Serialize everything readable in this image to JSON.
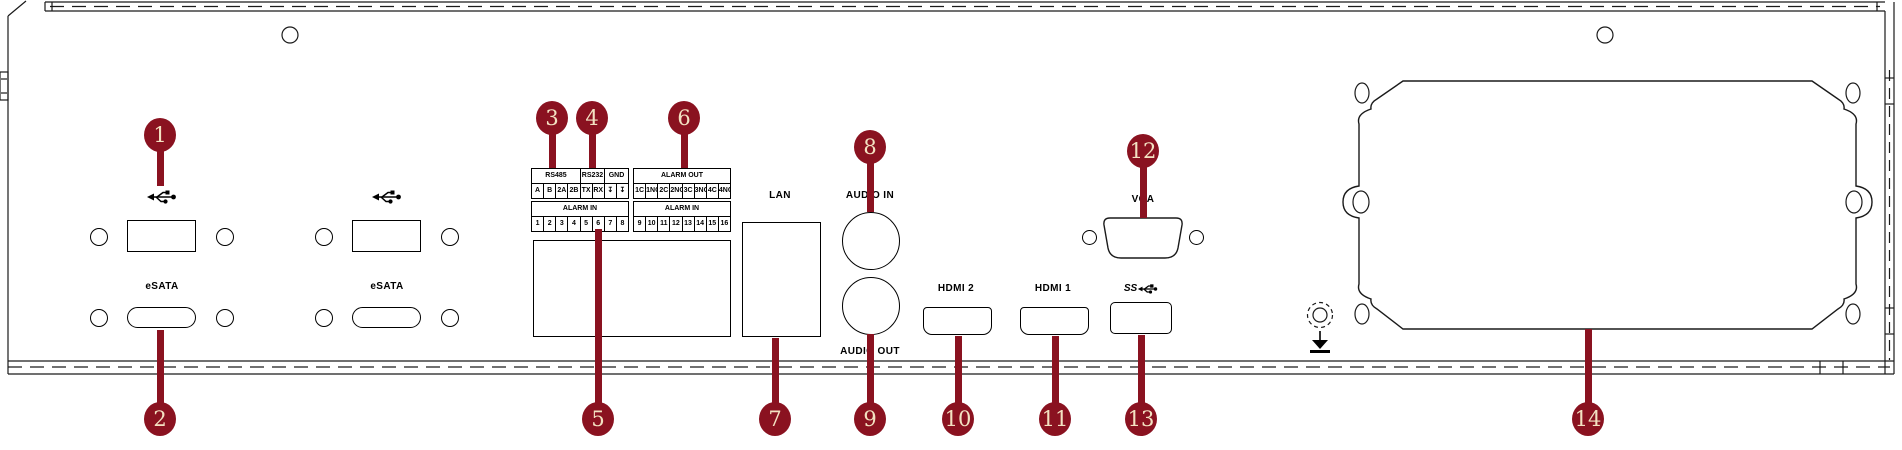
{
  "colors": {
    "callout_bg": "#8A1220",
    "callout_text": "#F3E2C2",
    "line": "#000000"
  },
  "panel": {
    "usb_groups": [
      {
        "icon": "usb-icon",
        "esata_label": "eSATA"
      },
      {
        "icon": "usb-icon",
        "esata_label": "eSATA"
      }
    ],
    "lan_label": "LAN",
    "audio_in_label": "AUDIO IN",
    "audio_out_label": "AUDIO OUT",
    "hdmi2_label": "HDMI 2",
    "hdmi1_label": "HDMI 1",
    "usb3_label": "SS",
    "vga_label": "VGA"
  },
  "terminal_block_a": {
    "headers": [
      {
        "label": "RS485",
        "span": 4
      },
      {
        "label": "RS232",
        "span": 2
      },
      {
        "label": "GND",
        "span": 2
      }
    ],
    "pins": [
      "A",
      "B",
      "2A",
      "2B",
      "TX",
      "RX",
      "↧",
      "↧"
    ],
    "alarm_in_label": "ALARM IN",
    "alarm_in_pins": [
      "1",
      "2",
      "3",
      "4",
      "5",
      "6",
      "7",
      "8"
    ]
  },
  "terminal_block_b": {
    "alarm_out_label": "ALARM OUT",
    "alarm_out_pins": [
      "1C",
      "1NO",
      "2C",
      "2NO",
      "3C",
      "3NO",
      "4C",
      "4NO"
    ],
    "alarm_in_label": "ALARM IN",
    "alarm_in_pins": [
      "9",
      "10",
      "11",
      "12",
      "13",
      "14",
      "15",
      "16"
    ]
  },
  "callouts": [
    {
      "number": "1"
    },
    {
      "number": "2"
    },
    {
      "number": "3"
    },
    {
      "number": "4"
    },
    {
      "number": "5"
    },
    {
      "number": "6"
    },
    {
      "number": "7"
    },
    {
      "number": "8"
    },
    {
      "number": "9"
    },
    {
      "number": "10"
    },
    {
      "number": "11"
    },
    {
      "number": "12"
    },
    {
      "number": "13"
    },
    {
      "number": "14"
    }
  ]
}
